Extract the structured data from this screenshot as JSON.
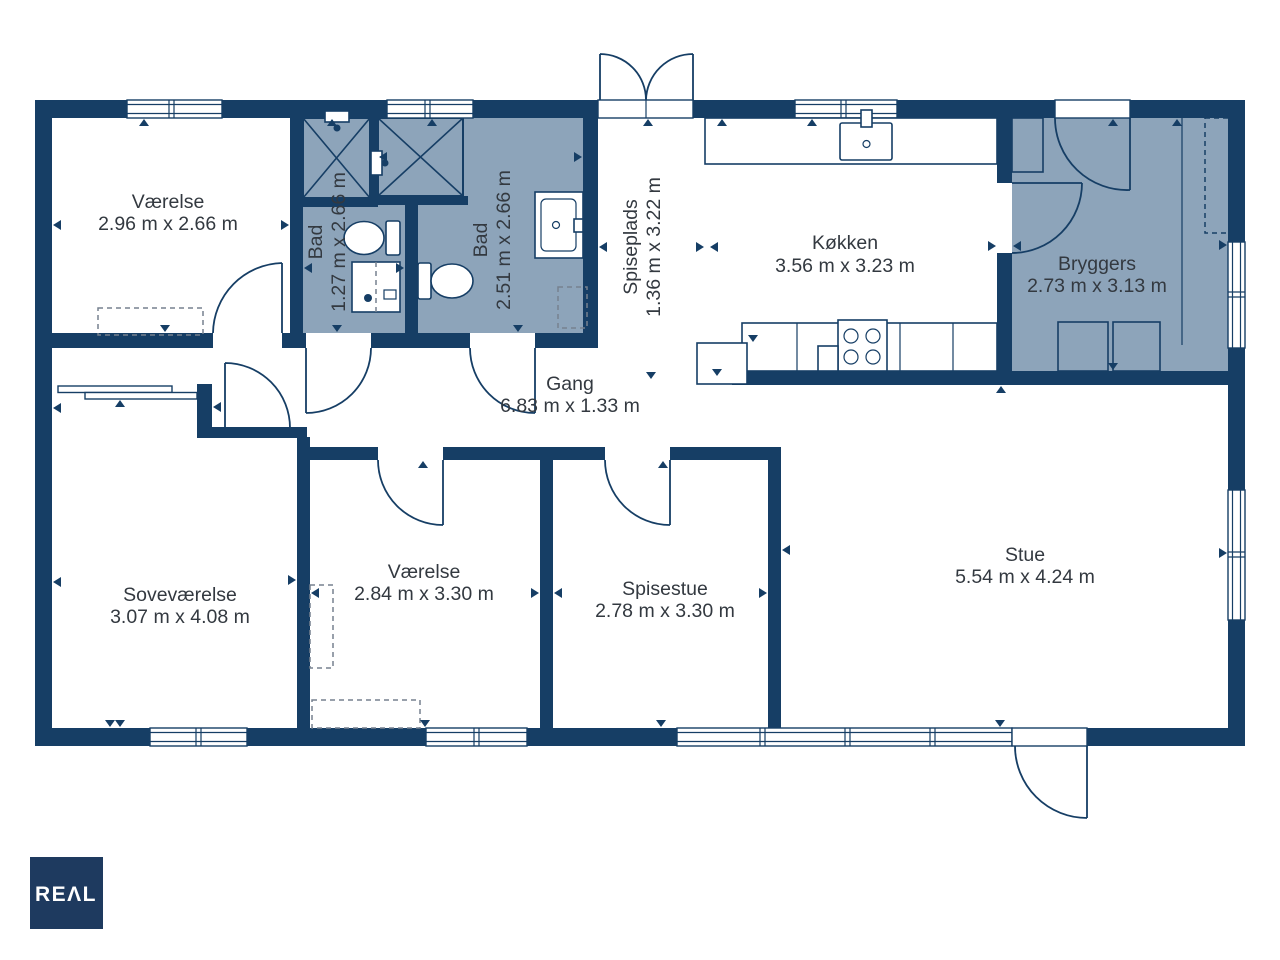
{
  "colors": {
    "wall": "#163E65",
    "room_shaded": "#8DA4BA",
    "text": "#333940",
    "logo_bg": "#1E3A5F",
    "logo_text": "#FFFFFF"
  },
  "rooms": {
    "vaerelse_nw": {
      "name": "Værelse",
      "dims": "2.96 m x 2.66 m"
    },
    "bad_small": {
      "name": "Bad",
      "dims": "1.27 m x 2.66 m"
    },
    "bad_large": {
      "name": "Bad",
      "dims": "2.51 m x 2.66 m"
    },
    "spiseplads": {
      "name": "Spiseplads",
      "dims": "1.36 m x 3.22 m"
    },
    "koekken": {
      "name": "Køkken",
      "dims": "3.56 m x 3.23 m"
    },
    "bryggers": {
      "name": "Bryggers",
      "dims": "2.73 m x 3.13 m"
    },
    "gang": {
      "name": "Gang",
      "dims": "6.83 m x 1.33 m"
    },
    "sovevaerelse": {
      "name": "Soveværelse",
      "dims": "3.07 m x 4.08 m"
    },
    "vaerelse_s": {
      "name": "Værelse",
      "dims": "2.84 m x 3.30 m"
    },
    "spisestue": {
      "name": "Spisestue",
      "dims": "2.78 m x 3.30 m"
    },
    "stue": {
      "name": "Stue",
      "dims": "5.54 m x 4.24 m"
    }
  },
  "logo": {
    "text": "REΛL"
  }
}
